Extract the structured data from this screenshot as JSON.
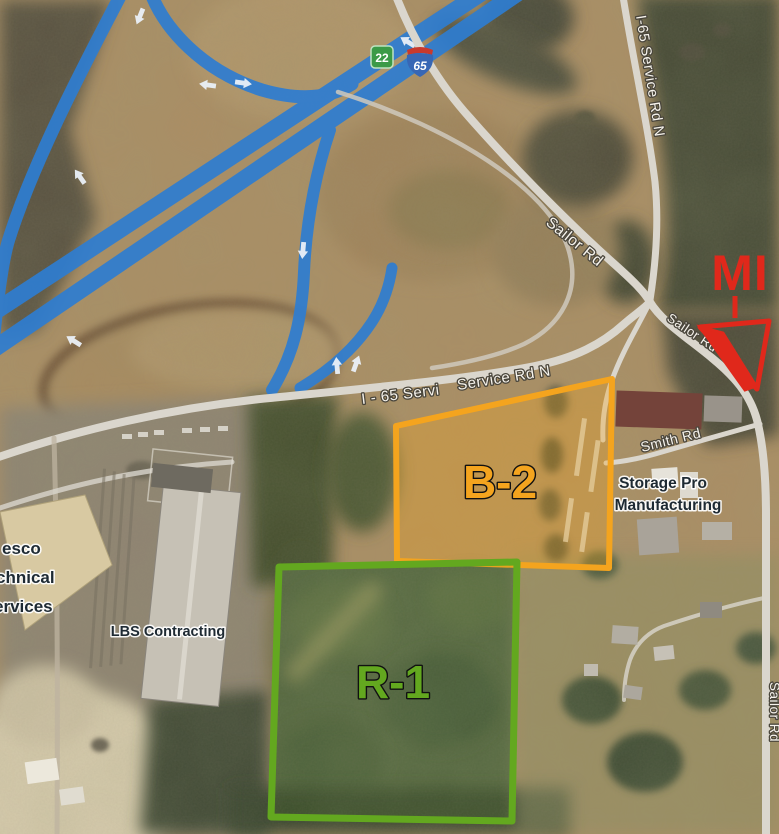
{
  "shields": {
    "state_route_22": "22",
    "interstate_65": "65",
    "state_route_color": "#3B9A47",
    "interstate_blue": "#3767B5",
    "interstate_red": "#C8392E"
  },
  "road_labels": {
    "i65_service_rd_n_ne": "I-65 Service Rd N",
    "i65_servi_partial": "I - 65 Servi",
    "service_rd_n": "Service Rd N",
    "sailor_rd_nw": "Sailor Rd",
    "sailor_rd_se": "Sailor Rd",
    "sailor_rd_s": "Sailor Rd",
    "smith_rd": "Smith Rd"
  },
  "place_labels": {
    "storage_pro_line1": "Storage Pro",
    "storage_pro_line2": "Manufacturing",
    "lbs_contracting": "LBS Contracting",
    "partial_business_line1": "esco",
    "partial_business_line2": "chnical",
    "partial_business_line3": "ervices"
  },
  "zones": {
    "b2": {
      "label": "B-2",
      "color": "#F4A41E",
      "fill": "rgba(244,164,30,0.32)"
    },
    "r1": {
      "label": "R-1",
      "color": "#63A81F",
      "fill": "rgba(110,175,40,0.10)"
    }
  },
  "annotation_mi": {
    "label": "MI",
    "color": "#E0281B"
  },
  "colors": {
    "route_highlight": "#2E7DD1",
    "terrain_tan": "#AB8E64",
    "forest_dark": "#49483A",
    "road_gray": "#DAD6CD"
  }
}
